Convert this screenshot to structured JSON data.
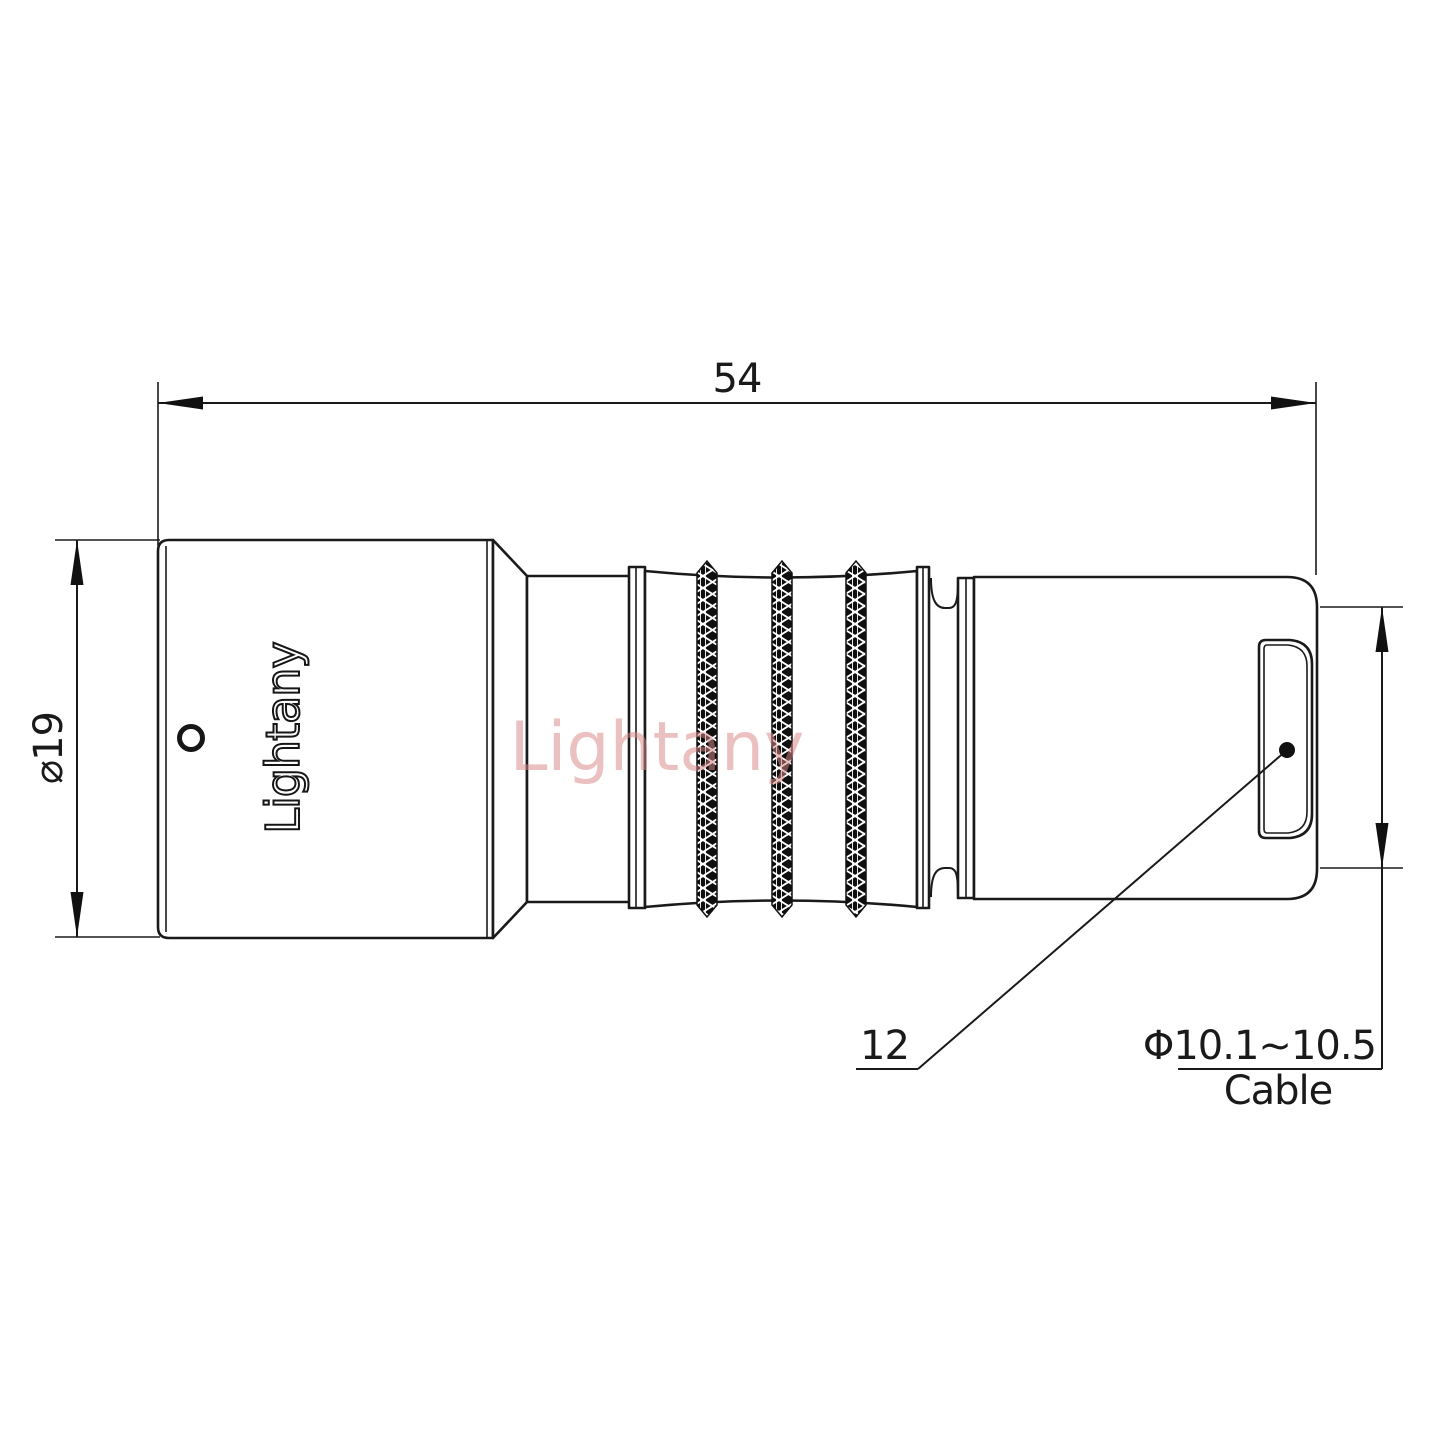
{
  "drawing": {
    "brand_engraving": "Lightany",
    "watermark": "Lightany",
    "dimensions": {
      "overall_length": "54",
      "body_diameter": "⌀19",
      "nut_size_label": "12",
      "cable_diameter_range": "Φ10.1~10.5",
      "cable_word": "Cable"
    },
    "colors": {
      "line": "#1a1a1a",
      "watermark_pink": "#d98888",
      "background": "#ffffff"
    }
  }
}
